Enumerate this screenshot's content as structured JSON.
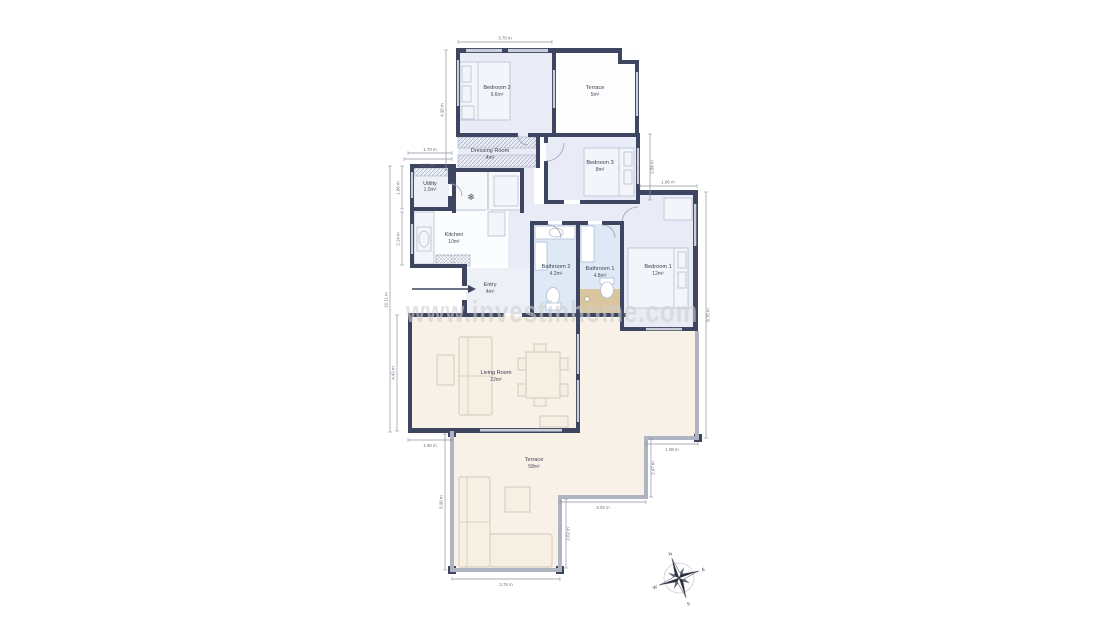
{
  "watermark": "www.investinhome.com",
  "rooms": {
    "bedroom2": {
      "name": "Bedroom 2",
      "area": "9.6m²"
    },
    "terrace_top": {
      "name": "Terrace",
      "area": "5m²"
    },
    "dressing_room": {
      "name": "Dressing Room",
      "area": "4m²"
    },
    "bedroom3": {
      "name": "Bedroom 3",
      "area": "8m²"
    },
    "utility": {
      "name": "Utility",
      "area": "1.0m²"
    },
    "kitchen": {
      "name": "Kitchen",
      "area": "10m²"
    },
    "entry": {
      "name": "Entry",
      "area": "4m²"
    },
    "bathroom2": {
      "name": "Bathroom 2",
      "area": "4.2m²"
    },
    "bathroom1": {
      "name": "Bathroom 1",
      "area": "4.8m²"
    },
    "bedroom1": {
      "name": "Bedroom 1",
      "area": "12m²"
    },
    "living_room": {
      "name": "Living Room",
      "area": "22m²"
    },
    "terrace_main": {
      "name": "Terrace",
      "area": "58m²"
    }
  },
  "dimensions": {
    "top_width": "3.70 m",
    "upper_left_height": "4.90 m",
    "utility_top_outer": "1.70 m",
    "utility_top_inner": "1.21 m",
    "utility_left": "1.88 m",
    "kitchen_left": "2.14 m",
    "left_full_height": "10.11 m",
    "living_left": "4.43 m",
    "living_bottom": "1.90 m",
    "terrace_left": "5.90 m",
    "terrace_bottom": "3.76 m",
    "terrace_right": "2.62 m",
    "terrace_mid": "3.02 m",
    "terrace_step_v": "2.47 m",
    "terrace_step_h": "1.98 m",
    "bedroom1_top": "1.96 m",
    "bedroom3_right": "2.88 m",
    "right_full_height": "8.70 m"
  },
  "compass": {
    "north": "N",
    "east": "E",
    "south": "S",
    "west": "W"
  },
  "icons": {
    "snowflake": "❄"
  },
  "colors": {
    "wall": "#3e4560",
    "bedroom_floor": "#e9ecf6",
    "bath_floor": "#dfe9f5",
    "living_floor": "#f8f1e8",
    "shower_floor": "#d9c5a0",
    "terrace_wall": "#aeb4c2",
    "watermark": "#cfcfcf"
  }
}
